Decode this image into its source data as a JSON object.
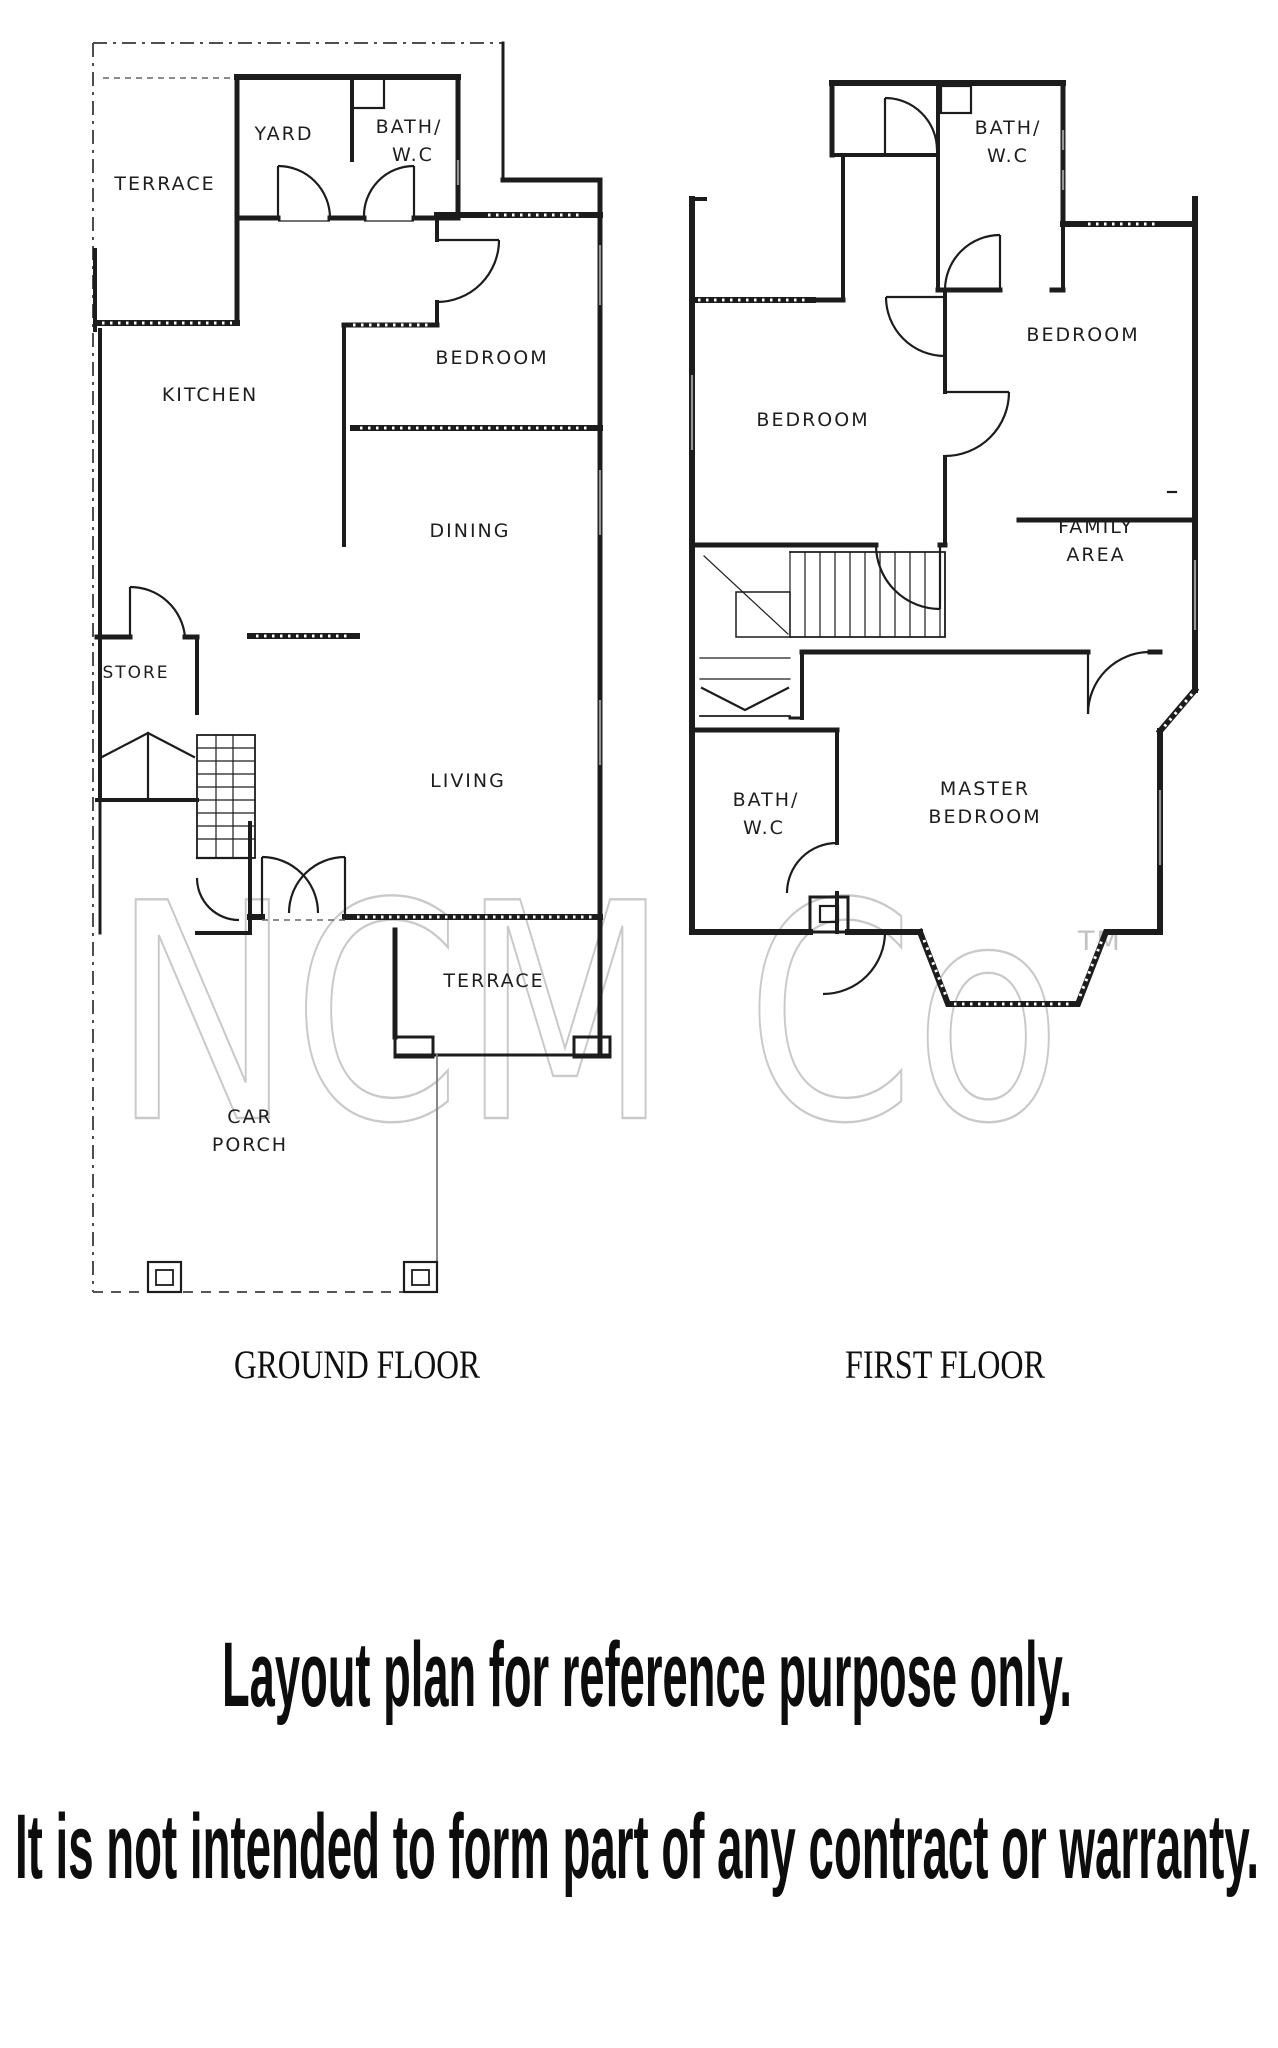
{
  "ground_floor": {
    "caption": "GROUND FLOOR",
    "rooms": {
      "terrace_top": "TERRACE",
      "yard": "YARD",
      "bath_line1": "BATH/",
      "bath_line2": "W.C",
      "bedroom": "BEDROOM",
      "kitchen": "KITCHEN",
      "dining": "DINING",
      "store": "STORE",
      "living": "LIVING",
      "terrace_bottom": "TERRACE",
      "car_porch_line1": "CAR",
      "car_porch_line2": "PORCH"
    }
  },
  "first_floor": {
    "caption": "FIRST FLOOR",
    "rooms": {
      "bath_top_line1": "BATH/",
      "bath_top_line2": "W.C",
      "bedroom_right": "BEDROOM",
      "bedroom_left": "BEDROOM",
      "family_area_line1": "FAMILY",
      "family_area_line2": "AREA",
      "bath_lower_line1": "BATH/",
      "bath_lower_line2": "W.C",
      "master_bedroom_line1": "MASTER",
      "master_bedroom_line2": "BEDROOM"
    }
  },
  "watermark": {
    "text": "NCM Co",
    "tm": "TM",
    "color": "#c9c9c9"
  },
  "disclaimer": {
    "line1": "Layout plan for reference purpose only.",
    "line2": "It is not intended to form part of any contract or warranty."
  },
  "colors": {
    "ink": "#1c1c1c",
    "paper": "#ffffff"
  }
}
